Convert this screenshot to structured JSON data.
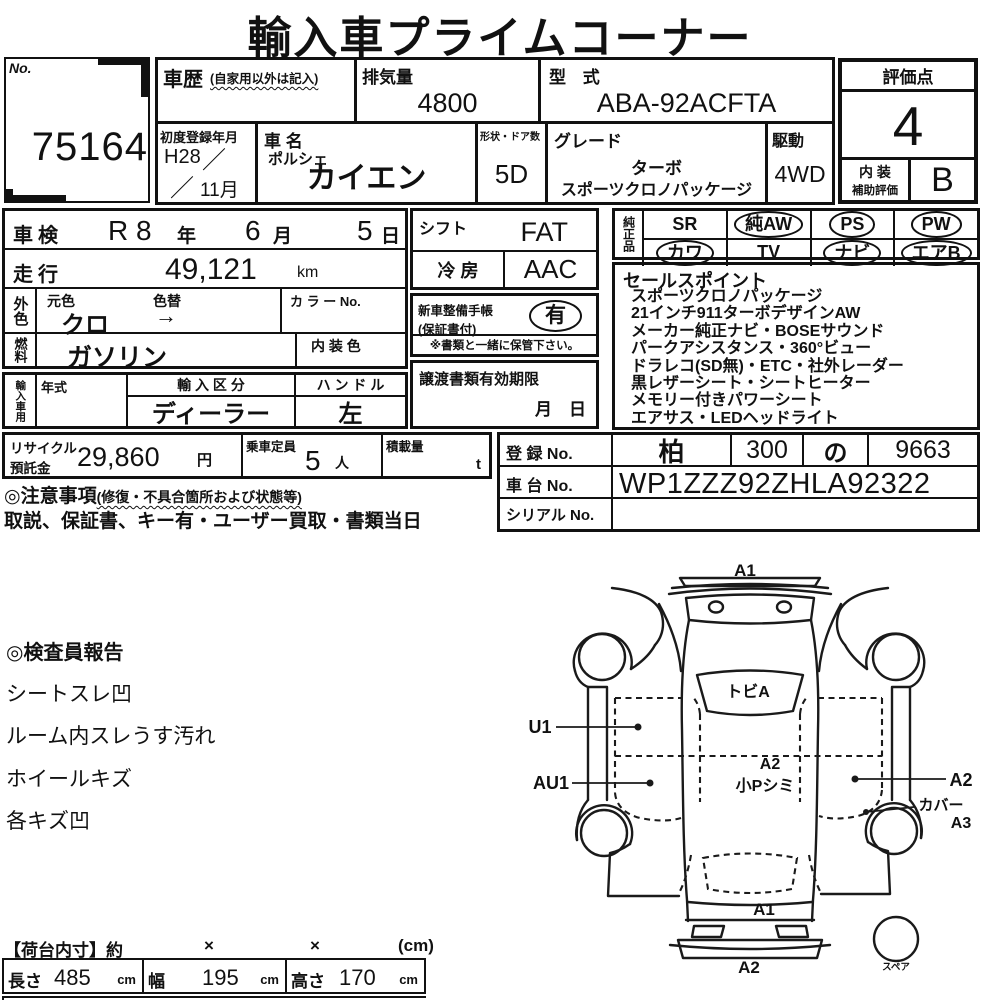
{
  "title": "輸入車プライムコーナー",
  "header": {
    "no_label": "No.",
    "auction_no": "75164",
    "history": {
      "label": "車歴",
      "note": "(自家用以外は記入)"
    },
    "displacement": {
      "label": "排気量",
      "value": "4800"
    },
    "model_code": {
      "label": "型 式",
      "value": "ABA-92ACFTA"
    },
    "first_reg": {
      "label": "初度登録年月",
      "era": "H28",
      "slash": "／",
      "month": "11月"
    },
    "car": {
      "label": "車 名",
      "maker": "ポルシェ",
      "name": "カイエン"
    },
    "body_doors": {
      "label": "形状・ドア数",
      "value": "5D"
    },
    "grade": {
      "label": "グレード",
      "line1": "ターボ",
      "line2": "スポーツクロノパッケージ"
    },
    "drive": {
      "label": "駆動",
      "value": "4WD"
    },
    "score": {
      "label": "評価点",
      "value": "4"
    },
    "interior": {
      "label1": "内 装",
      "label2": "補助評価",
      "value": "B"
    }
  },
  "inspection": {
    "label": "車検",
    "era": "R 8",
    "y": "年",
    "month_val": "6",
    "m": "月",
    "day_val": "5",
    "d": "日"
  },
  "mileage": {
    "label": "走行",
    "value": "49,121",
    "unit": "km"
  },
  "color": {
    "label": "外色",
    "orig_label": "元色",
    "change_label": "色替",
    "value": "クロ",
    "arrow": "→",
    "color_no_label": "カ ラ ー No."
  },
  "fuel": {
    "label": "燃料",
    "value": "ガソリン",
    "interior_color_label": "内 装 色"
  },
  "import": {
    "label": "輸入車用",
    "year_label": "年式",
    "division_label": "輸 入 区 分",
    "division_value": "ディーラー",
    "handle_label": "ハ ン ド ル",
    "handle_value": "左"
  },
  "shift": {
    "label": "シフト",
    "value": "FAT"
  },
  "ac": {
    "label": "冷 房",
    "value": "AAC"
  },
  "service_book": {
    "label1": "新車整備手帳",
    "label2": "(保証書付)",
    "value": "有",
    "note": "※書類と一緒に保管下さい。"
  },
  "transfer_docs": {
    "label": "譲渡書類有効期限",
    "month": "月",
    "day": "日"
  },
  "equipment": {
    "label": "純正品",
    "items": [
      {
        "name": "SR",
        "circled": false
      },
      {
        "name": "純AW",
        "circled": true
      },
      {
        "name": "PS",
        "circled": true
      },
      {
        "name": "PW",
        "circled": true
      },
      {
        "name": "カワ",
        "circled": true
      },
      {
        "name": "TV",
        "circled": false
      },
      {
        "name": "ナビ",
        "circled": true
      },
      {
        "name": "エアB",
        "circled": true
      }
    ]
  },
  "sales_points": {
    "label": "セールスポイント",
    "lines": [
      "スポーツクロノパッケージ",
      "21インチ911ターボデザインAW",
      "メーカー純正ナビ・BOSEサウンド",
      "パークアシスタンス・360°ビュー",
      "ドラレコ(SD無)・ETC・社外レーダー",
      "黒レザーシート・シートヒーター",
      "メモリー付きパワーシート",
      "エアサス・LEDヘッドライト"
    ]
  },
  "recycle": {
    "label1": "リサイクル",
    "label2": "預託金",
    "value": "29,860",
    "unit": "円"
  },
  "capacity": {
    "label": "乗車定員",
    "value": "5",
    "unit": "人"
  },
  "load": {
    "label": "積載量",
    "unit": "t"
  },
  "registration": {
    "label": "登 録 No.",
    "v1": "柏",
    "v2": "300",
    "v3": "の",
    "v4": "9663"
  },
  "chassis": {
    "label": "車 台 No.",
    "value": "WP1ZZZ92ZHLA92322"
  },
  "serial": {
    "label": "シリアル No.",
    "value": ""
  },
  "notes": {
    "heading": "◎注意事項",
    "heading_note": "(修復・不具合箇所および状態等)",
    "line": "取説、保証書、キー有・ユーザー買取・書類当日"
  },
  "inspector_report": {
    "heading": "◎検査員報告",
    "lines": [
      "シートスレ凹",
      "ルーム内スレうす汚れ",
      "ホイールキズ",
      "各キズ凹"
    ]
  },
  "diagram": {
    "a1_front": "A1",
    "tobi": "トビA",
    "u1": "U1",
    "au1": "AU1",
    "a2_roof": "A2",
    "roof_note": "小Pシミ",
    "a2_right": "A2",
    "cover": "カバー",
    "a3": "A3",
    "a1_rear": "A1",
    "a2_rear": "A2",
    "spare": "スペア"
  },
  "cargo": {
    "heading": "【荷台内寸】約",
    "x1": "×",
    "x2": "×",
    "unit_note": "(cm)",
    "length_label": "長さ",
    "length": "485",
    "length_unit": "cm",
    "width_label": "幅",
    "width": "195",
    "width_unit": "cm",
    "height_label": "高さ",
    "height": "170",
    "height_unit": "cm"
  }
}
